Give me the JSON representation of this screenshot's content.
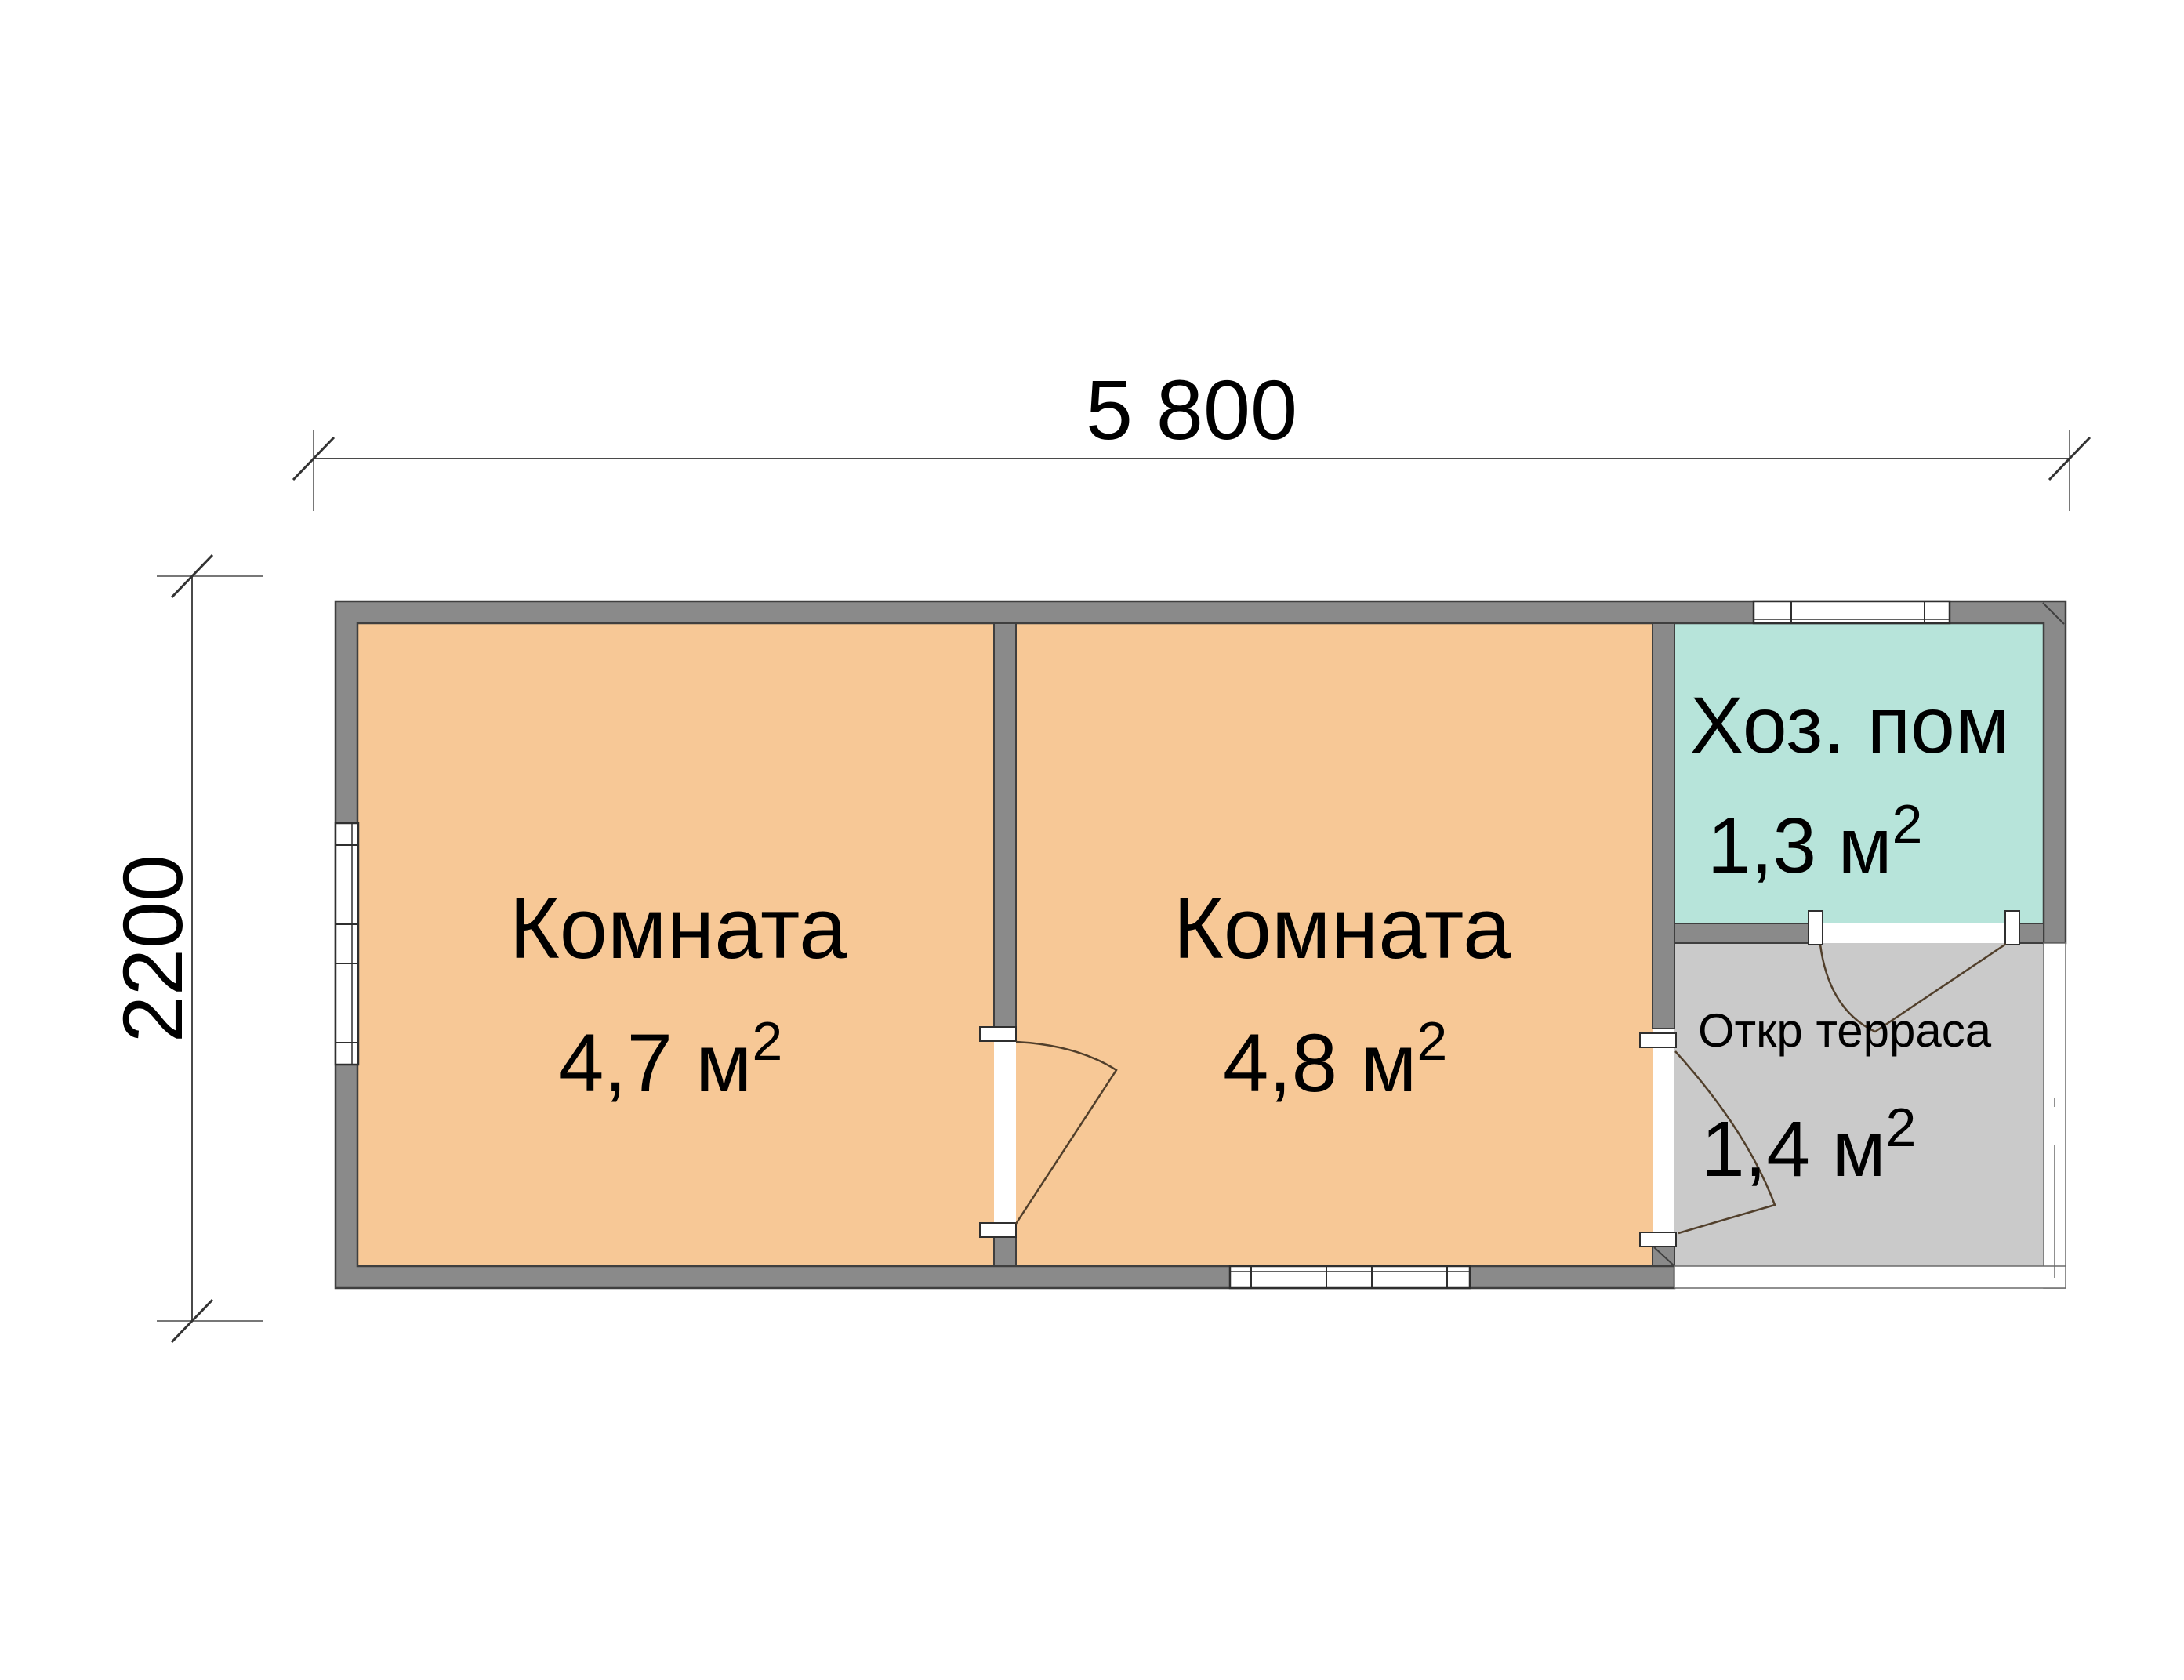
{
  "drawing": {
    "type": "floor-plan",
    "dimensions": {
      "width_label": "5 800",
      "height_label": "2200"
    },
    "rooms": [
      {
        "name": "Комната",
        "area": "4,7 м",
        "sup": "2"
      },
      {
        "name": "Комната",
        "area": "4,8 м",
        "sup": "2"
      },
      {
        "name": "Хоз. пом",
        "area": "1,3 м",
        "sup": "2"
      },
      {
        "name": "Откр терраса",
        "area": "1,4 м",
        "sup": "2"
      }
    ],
    "colors": {
      "wall": "#8A8A8A",
      "wall_outline": "#3F3F3F",
      "room_fill": "#F7C896",
      "utility_fill": "#B7E4DA",
      "terrace_fill": "#CACACA",
      "window_fill": "#FFFFFF",
      "door_line": "#513F2B",
      "dim_line": "#4A4A4A"
    }
  }
}
